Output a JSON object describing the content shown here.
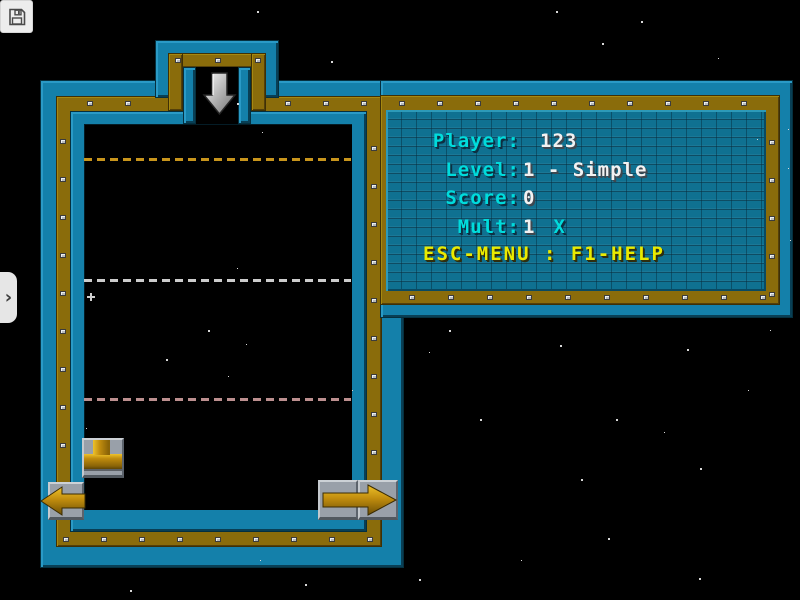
{
  "window": {
    "save_button_icon": "floppy-disk",
    "sidebar_toggle_glyph": "›"
  },
  "panel": {
    "rows": [
      {
        "label": "Player:",
        "value": "123",
        "suffix": "",
        "indent": 20
      },
      {
        "label": "Level:",
        "value": "1 - Simple",
        "suffix": "",
        "indent": 3
      },
      {
        "label": "Score:",
        "value": "0",
        "suffix": "",
        "indent": 3
      },
      {
        "label": "Mult:",
        "value": "1",
        "suffix": "X",
        "indent": 3
      }
    ],
    "help_text": "ESC-MENU : F1-HELP"
  },
  "hud_colors": {
    "label_cyan": "#00dcdc",
    "value_white": "#f2f2f2",
    "help_yellow": "#eaea00",
    "frame_teal": "#1480aa",
    "frame_gold": "#8a6c0b",
    "pipe_gold": "#c08c0e"
  },
  "well": {
    "guide_lines": [
      {
        "y": 158,
        "color": "#c8951c"
      },
      {
        "y": 279,
        "color": "#cccccc"
      },
      {
        "y": 398,
        "color": "#bc8f8f"
      }
    ]
  },
  "stars": [
    {
      "x": 257,
      "y": 11,
      "s": 2
    },
    {
      "x": 556,
      "y": 11,
      "s": 2
    },
    {
      "x": 641,
      "y": 21,
      "s": 2
    },
    {
      "x": 602,
      "y": 43,
      "s": 2
    },
    {
      "x": 331,
      "y": 61,
      "s": 2
    },
    {
      "x": 718,
      "y": 58,
      "s": 1
    },
    {
      "x": 237,
      "y": 103,
      "s": 2
    },
    {
      "x": 262,
      "y": 132,
      "s": 1
    },
    {
      "x": 757,
      "y": 139,
      "s": 1
    },
    {
      "x": 788,
      "y": 168,
      "s": 1
    },
    {
      "x": 788,
      "y": 129,
      "s": 1
    },
    {
      "x": 237,
      "y": 268,
      "s": 1
    },
    {
      "x": 10,
      "y": 310,
      "s": 2
    },
    {
      "x": 87,
      "y": 293,
      "s": 0,
      "type": "plus"
    },
    {
      "x": 208,
      "y": 330,
      "s": 2
    },
    {
      "x": 246,
      "y": 344,
      "s": 1
    },
    {
      "x": 166,
      "y": 359,
      "s": 2
    },
    {
      "x": 228,
      "y": 376,
      "s": 1
    },
    {
      "x": 352,
      "y": 390,
      "s": 1
    },
    {
      "x": 449,
      "y": 330,
      "s": 2
    },
    {
      "x": 429,
      "y": 352,
      "s": 1
    },
    {
      "x": 560,
      "y": 345,
      "s": 2
    },
    {
      "x": 687,
      "y": 349,
      "s": 2
    },
    {
      "x": 748,
      "y": 390,
      "s": 1
    },
    {
      "x": 480,
      "y": 419,
      "s": 2
    },
    {
      "x": 616,
      "y": 419,
      "s": 2
    },
    {
      "x": 664,
      "y": 432,
      "s": 1
    },
    {
      "x": 700,
      "y": 468,
      "s": 2
    },
    {
      "x": 581,
      "y": 479,
      "s": 2
    },
    {
      "x": 608,
      "y": 538,
      "s": 2
    },
    {
      "x": 699,
      "y": 578,
      "s": 2
    },
    {
      "x": 419,
      "y": 579,
      "s": 2
    },
    {
      "x": 305,
      "y": 584,
      "s": 2
    },
    {
      "x": 521,
      "y": 560,
      "s": 1
    },
    {
      "x": 86,
      "y": 428,
      "s": 1
    },
    {
      "x": 130,
      "y": 590,
      "s": 2
    },
    {
      "x": 260,
      "y": 560,
      "s": 1
    },
    {
      "x": 790,
      "y": 240,
      "s": 1
    },
    {
      "x": 770,
      "y": 330,
      "s": 1
    }
  ]
}
